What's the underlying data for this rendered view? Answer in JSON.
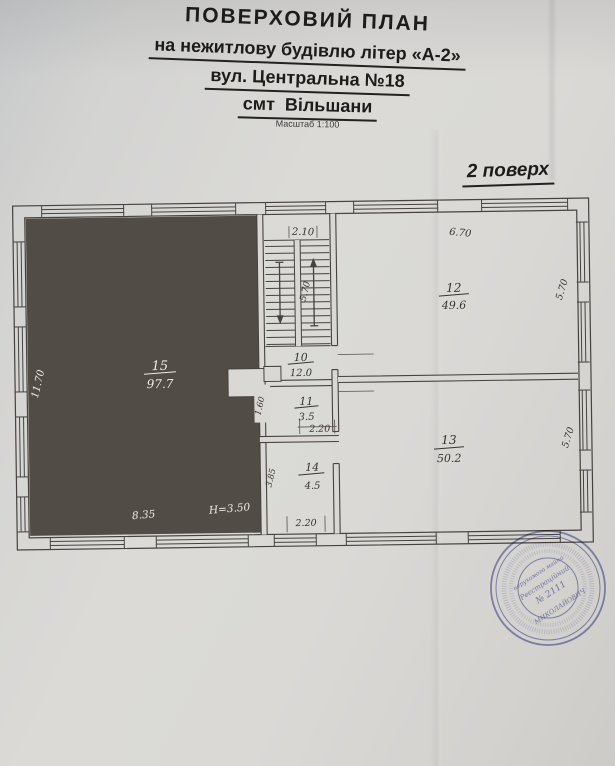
{
  "header": {
    "title": "ПОВЕРХОВИЙ ПЛАН",
    "subtitle1": "на нежитлову будівлю літер «А-2»",
    "subtitle2": "вул. Центральна №18",
    "subtitle3": "смт  Вільшани",
    "scale": "Масштаб 1:100",
    "floor": "2 поверх"
  },
  "plan": {
    "rooms": {
      "r15": {
        "num": "15",
        "area": "97.7"
      },
      "r12": {
        "num": "12",
        "area": "49.6"
      },
      "r13": {
        "num": "13",
        "area": "50.2"
      },
      "r10": {
        "num": "10",
        "area": "12.0"
      },
      "r11": {
        "num": "11",
        "area": "3.5"
      },
      "r14": {
        "num": "14",
        "area": "4.5"
      }
    },
    "dims": {
      "top_middle": "2.10",
      "top_right": "6.70",
      "right_room12": "5.70",
      "right_room13": "5.70",
      "stair_flight": "5.70",
      "left_room15": "11.70",
      "bottom_room15": "8.35",
      "room15_height": "H=3.50",
      "room11_width": "2.20",
      "room14_width": "2.20",
      "left_room11": "1.60",
      "left_room14": "3.85"
    }
  },
  "stamp": {
    "line1": "нерухомого майна",
    "line2": "Реєстраційний",
    "line3": "№ 2111",
    "line4": "МИКОЛАЙОВИЧ"
  },
  "colors": {
    "dark_room_fill": "#524c47",
    "drawing_line": "#45423f",
    "stamp_blue": "#6b70b3",
    "paper": "#d9d8d5"
  }
}
